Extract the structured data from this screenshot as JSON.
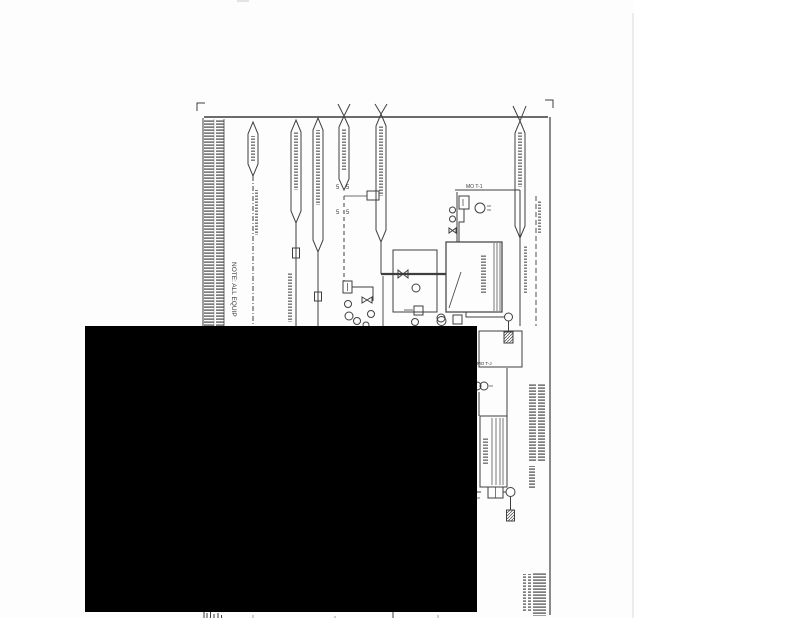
{
  "colors": {
    "page_background": "#fdfdfd",
    "paper_white": "#ffffff",
    "ink": "#2f2f2f",
    "redaction": "#000000",
    "page_edge": "#dcdcdc"
  },
  "drawing": {
    "note_label": "NOTE: ALL EQUIP",
    "t1_box_label": "MO T-1",
    "t2_box_label": "MO T-J",
    "five_glyph": "5"
  }
}
